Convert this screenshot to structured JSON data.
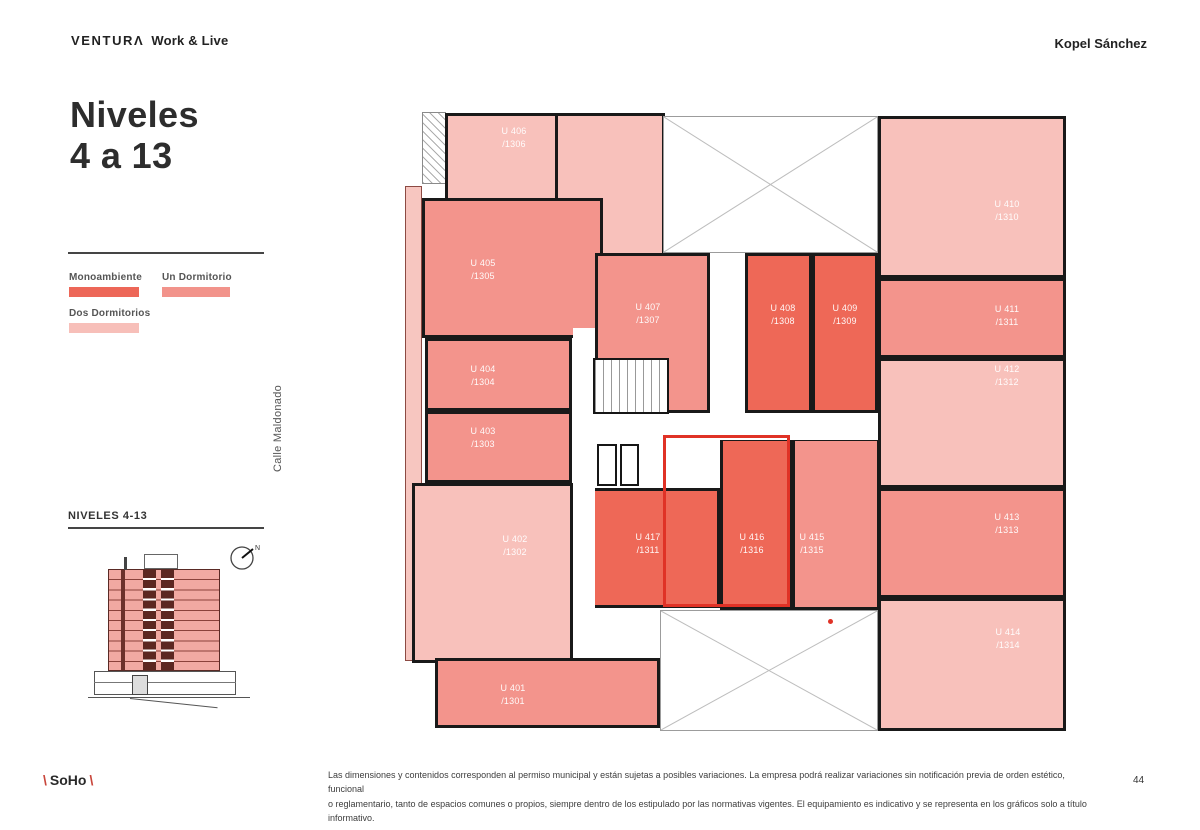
{
  "header": {
    "brand": "VENTURΛ",
    "tagline": "Work & Live",
    "architect": "Kopel Sánchez"
  },
  "title": {
    "line1": "Niveles",
    "line2": "4 a 13"
  },
  "legend": {
    "items": [
      {
        "key": "mono",
        "label": "Monoambiente",
        "color": "#ed6758"
      },
      {
        "key": "un",
        "label": "Un Dormitorio",
        "color": "#f2938b"
      },
      {
        "key": "dos",
        "label": "Dos Dormitorios",
        "color": "#f7bfb9"
      }
    ]
  },
  "street_label": "Calle Maldonado",
  "levels_panel": {
    "label": "NIVELES 4-13",
    "compass_label": "N"
  },
  "plan": {
    "colors": {
      "mono": "#ee6857",
      "un": "#f3948c",
      "dos": "#f8c1bb",
      "wall": "#191919",
      "highlight": "#e03226"
    },
    "units": [
      {
        "unit": "U 406",
        "number": "/1306",
        "type": "dos",
        "rects": [
          [
            45,
            7,
            218,
            88
          ],
          [
            155,
            7,
            110,
            150
          ]
        ],
        "label": [
          114,
          32
        ]
      },
      {
        "unit": "U 405",
        "number": "/1305",
        "type": "un",
        "rects": [
          [
            22,
            92,
            181,
            140
          ]
        ],
        "label": [
          83,
          164
        ]
      },
      {
        "unit": "U 404",
        "number": "/1304",
        "type": "un",
        "rects": [
          [
            25,
            232,
            147,
            73
          ]
        ],
        "label": [
          83,
          270
        ]
      },
      {
        "unit": "U 403",
        "number": "/1303",
        "type": "un",
        "rects": [
          [
            25,
            305,
            147,
            72
          ]
        ],
        "label": [
          83,
          332
        ]
      },
      {
        "unit": "U 402",
        "number": "/1302",
        "type": "dos",
        "rects": [
          [
            12,
            377,
            161,
            180
          ]
        ],
        "label": [
          115,
          440
        ]
      },
      {
        "unit": "U 401",
        "number": "/1301",
        "type": "un",
        "rects": [
          [
            35,
            552,
            225,
            70
          ]
        ],
        "label": [
          113,
          589
        ]
      },
      {
        "unit": "U 407",
        "number": "/1307",
        "type": "un",
        "rects": [
          [
            195,
            147,
            115,
            160
          ]
        ],
        "label": [
          248,
          208
        ]
      },
      {
        "unit": "U 408",
        "number": "/1308",
        "type": "mono",
        "rects": [
          [
            345,
            147,
            67,
            160
          ]
        ],
        "label": [
          383,
          209
        ]
      },
      {
        "unit": "U 409",
        "number": "/1309",
        "type": "mono",
        "rects": [
          [
            412,
            147,
            66,
            160
          ]
        ],
        "label": [
          445,
          209
        ]
      },
      {
        "unit": "U 410",
        "number": "/1310",
        "type": "dos",
        "rects": [
          [
            478,
            10,
            188,
            162
          ]
        ],
        "label": [
          607,
          105
        ]
      },
      {
        "unit": "U 411",
        "number": "/1311",
        "type": "un",
        "rects": [
          [
            478,
            172,
            188,
            80
          ]
        ],
        "label": [
          607,
          210
        ]
      },
      {
        "unit": "U 412",
        "number": "/1312",
        "type": "dos",
        "rects": [
          [
            478,
            252,
            188,
            130
          ]
        ],
        "label": [
          607,
          270
        ]
      },
      {
        "unit": "U 413",
        "number": "/1313",
        "type": "un",
        "rects": [
          [
            478,
            382,
            188,
            110
          ]
        ],
        "label": [
          607,
          418
        ]
      },
      {
        "unit": "U 414",
        "number": "/1314",
        "type": "dos",
        "rects": [
          [
            478,
            492,
            188,
            133
          ]
        ],
        "label": [
          608,
          533
        ]
      },
      {
        "unit": "U 415",
        "number": "/1315",
        "type": "un",
        "rects": [
          [
            392,
            332,
            88,
            172
          ]
        ],
        "label": [
          412,
          438
        ]
      },
      {
        "unit": "U 416",
        "number": "/1316",
        "type": "mono",
        "rects": [
          [
            320,
            332,
            72,
            172
          ]
        ],
        "label": [
          352,
          438
        ]
      },
      {
        "unit": "U 417",
        "number": "/1311",
        "type": "mono",
        "rects": [
          [
            192,
            382,
            128,
            120
          ]
        ],
        "label": [
          248,
          438
        ]
      }
    ],
    "highlight_rect": [
      263,
      329,
      127,
      172
    ],
    "red_dot": [
      428,
      513
    ]
  },
  "footer": {
    "line1": "Las dimensiones y contenidos corresponden al permiso municipal y están sujetas a posibles variaciones. La empresa podrá realizar variaciones sin notificación previa de orden estético, funcional",
    "line2": "o reglamentario, tanto de espacios comunes o propios, siempre dentro de los estipulado por las normativas vigentes. El equipamiento es indicativo y se representa en los gráficos solo a título informativo.",
    "brand_pre": "\\",
    "brand": "SoHo",
    "brand_post": "\\",
    "page": "44"
  }
}
